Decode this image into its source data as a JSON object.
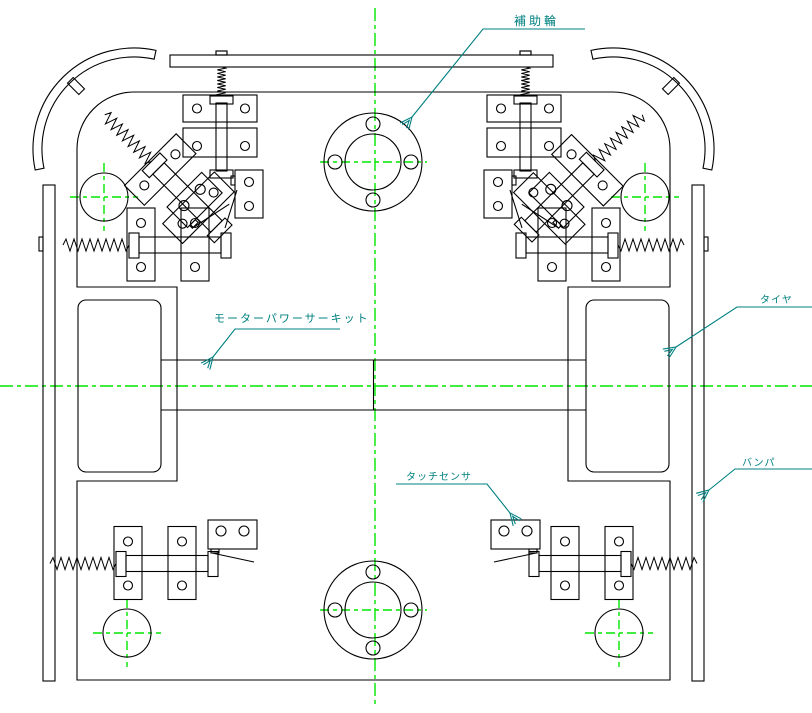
{
  "drawing": {
    "type": "cad-top-view-robot-chassis",
    "labels": {
      "auxiliary_wheel": "補助輪",
      "motor_power_circuit": "モーターパワーサーキット",
      "tire": "タイヤ",
      "bumper": "バンパ",
      "touch_sensor": "タッチセンサ"
    },
    "colors": {
      "line": "#000000",
      "centerline": "#00e600",
      "annotation": "#008080",
      "background": "#ffffff"
    }
  }
}
